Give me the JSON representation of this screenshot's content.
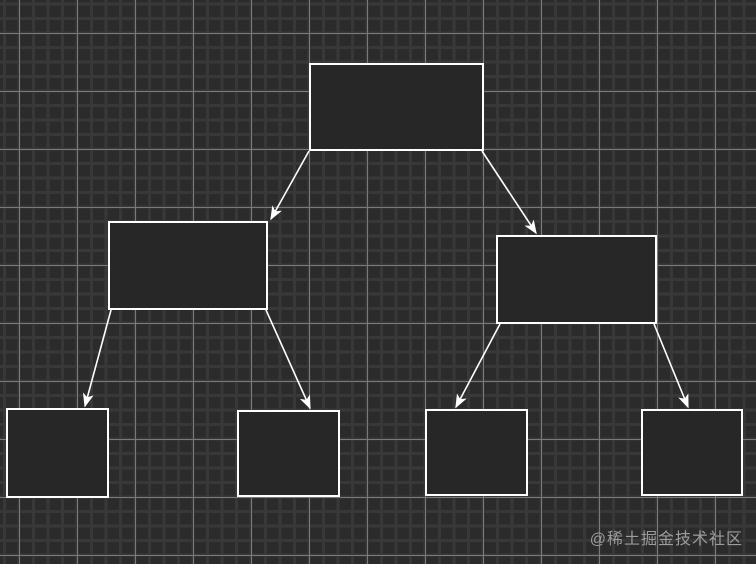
{
  "canvas": {
    "width": 756,
    "height": 564,
    "background_color": "#2b2b2b",
    "grid": {
      "minor_cell_px": 14.5,
      "major_cell_px": 58,
      "minor_line_color": "#383838",
      "major_line_color": "#7a7a7a"
    }
  },
  "diagram": {
    "type": "flowchart-tree",
    "node_fill": "#272727",
    "node_border_color": "#ffffff",
    "node_border_width": 2,
    "edge_color": "#ffffff",
    "edge_width": 1.6,
    "nodes": [
      {
        "id": "root",
        "label": "",
        "x": 310,
        "y": 64,
        "w": 173,
        "h": 86
      },
      {
        "id": "child-left",
        "label": "",
        "x": 109,
        "y": 222,
        "w": 158,
        "h": 87
      },
      {
        "id": "child-right",
        "label": "",
        "x": 497,
        "y": 236,
        "w": 159,
        "h": 87
      },
      {
        "id": "leaf-1",
        "label": "",
        "x": 7,
        "y": 409,
        "w": 101,
        "h": 88
      },
      {
        "id": "leaf-2",
        "label": "",
        "x": 238,
        "y": 411,
        "w": 101,
        "h": 85
      },
      {
        "id": "leaf-3",
        "label": "",
        "x": 426,
        "y": 410,
        "w": 101,
        "h": 85
      },
      {
        "id": "leaf-4",
        "label": "",
        "x": 642,
        "y": 410,
        "w": 100,
        "h": 85
      }
    ],
    "edges": [
      {
        "id": "root-to-child-left",
        "from": "root",
        "to": "child-left",
        "x1": 309,
        "y1": 151,
        "x2": 271,
        "y2": 219
      },
      {
        "id": "root-to-child-right",
        "from": "root",
        "to": "child-right",
        "x1": 482,
        "y1": 151,
        "x2": 536,
        "y2": 233
      },
      {
        "id": "child-left-to-leaf-1",
        "from": "child-left",
        "to": "leaf-1",
        "x1": 111,
        "y1": 310,
        "x2": 85,
        "y2": 406
      },
      {
        "id": "child-left-to-leaf-2",
        "from": "child-left",
        "to": "leaf-2",
        "x1": 266,
        "y1": 310,
        "x2": 310,
        "y2": 408
      },
      {
        "id": "child-right-to-leaf-3",
        "from": "child-right",
        "to": "leaf-3",
        "x1": 500,
        "y1": 324,
        "x2": 456,
        "y2": 407
      },
      {
        "id": "child-right-to-leaf-4",
        "from": "child-right",
        "to": "leaf-4",
        "x1": 654,
        "y1": 324,
        "x2": 688,
        "y2": 407
      }
    ]
  },
  "watermark": {
    "text": "@稀土掘金技术社区",
    "color": "#9c9c9c"
  }
}
